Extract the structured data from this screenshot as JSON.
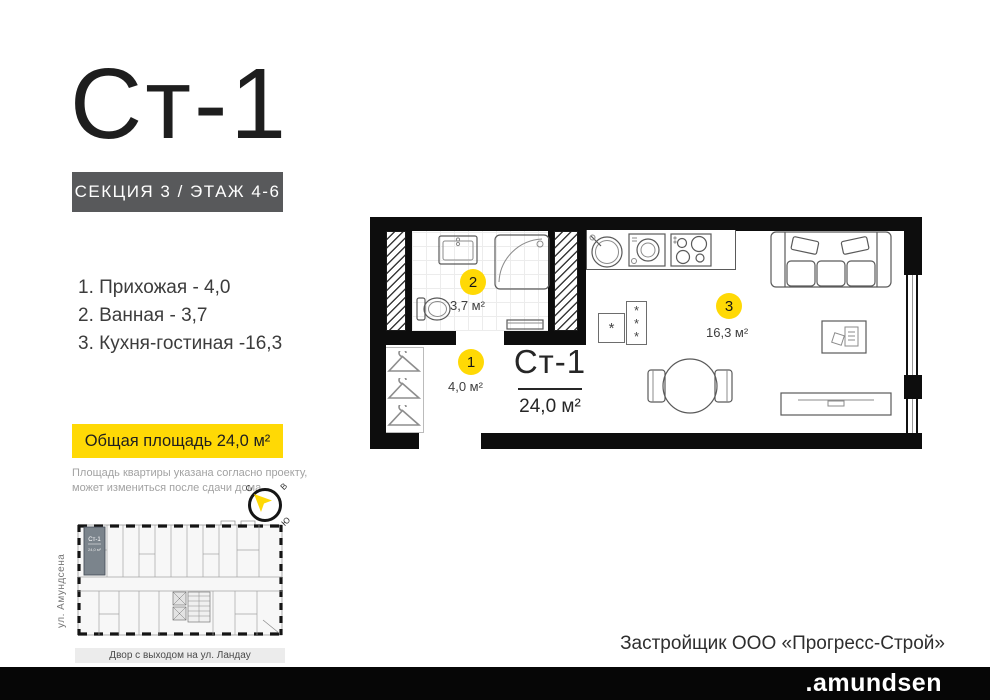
{
  "header": {
    "title": "Ст-1",
    "section_badge": "СЕКЦИЯ 3 / ЭТАЖ 4-6"
  },
  "room_list": {
    "items": [
      "1. Прихожая - 4,0",
      "2. Ванная - 3,7",
      "3. Кухня-гостиная -16,3"
    ]
  },
  "summary": {
    "total_badge": "Общая площадь 24,0 м²",
    "disclaimer_line1": "Площадь квартиры указана согласно проекту,",
    "disclaimer_line2": "может измениться после сдачи дома"
  },
  "compass": {
    "north": "С",
    "east": "В",
    "south": "Ю",
    "west": "З"
  },
  "plan": {
    "unit_title": "Ст-1",
    "total_area": "24,0 м²",
    "markers": [
      {
        "num": "1",
        "area": "4,0 м²"
      },
      {
        "num": "2",
        "area": "3,7 м²"
      },
      {
        "num": "3",
        "area": "16,3 м²"
      }
    ],
    "vent_single": "*",
    "vent_triple": "*\n*\n*"
  },
  "key_plan": {
    "unit_label": "Ст-1",
    "street_label": "ул. Амундсена",
    "yard_label": "Двор с выходом на ул. Ландау"
  },
  "footer": {
    "developer": "Застройщик ООО «Прогресс-Строй»",
    "brand": ".amundsen"
  },
  "colors": {
    "accent_yellow": "#ffd905",
    "badge_gray": "#58595b",
    "wall_black": "#0d0d0d",
    "key_plan_highlight": "#7b848c"
  }
}
